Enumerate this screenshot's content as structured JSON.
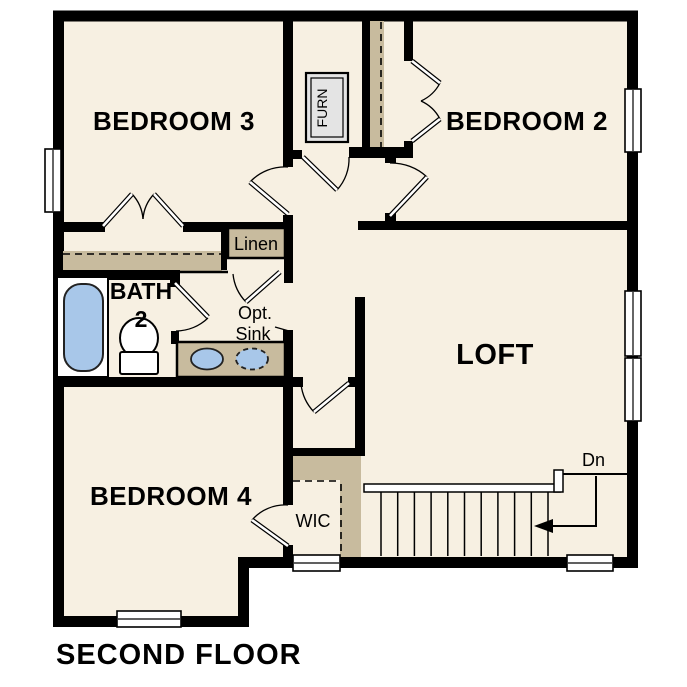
{
  "plan": {
    "title": "SECOND FLOOR",
    "rooms": {
      "bedroom3": "BEDROOM 3",
      "bedroom2": "BEDROOM 2",
      "bedroom4": "BEDROOM 4",
      "loft": "LOFT",
      "bath_line1": "BATH",
      "bath_line2": "2",
      "linen": "Linen",
      "wic": "WIC",
      "furnace": "FURN"
    },
    "annotations": {
      "opt_sink_line1": "Opt.",
      "opt_sink_line2": "Sink",
      "stair_direction": "Dn"
    },
    "colors": {
      "paper": "#ffffff",
      "floor": "#f7f0e2",
      "wall": "#000000",
      "shelf": "#c8bb9e",
      "fixture_blue": "#a8c7e9",
      "furn_gray": "#e4e4e4"
    }
  }
}
